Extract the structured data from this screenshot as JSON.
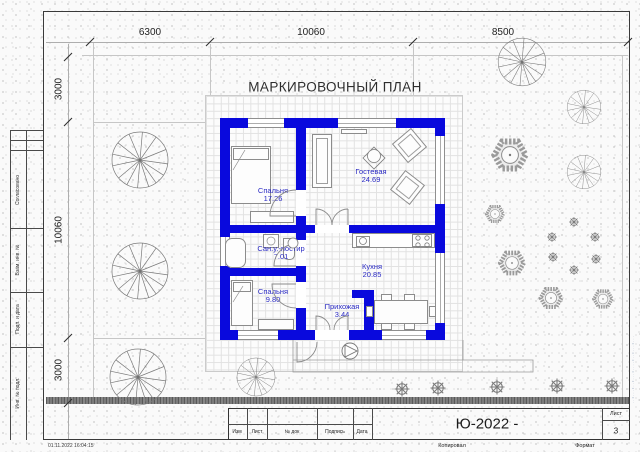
{
  "sheet": {
    "plan_title": "МАРКИРОВОЧНЫЙ ПЛАН",
    "timestamp": "01.11.2022 16:04:15",
    "watermark_text": "···•···•··•····•···•··•···•··"
  },
  "dimensions": {
    "top": [
      "6300",
      "10060",
      "8500"
    ],
    "left": [
      "3000",
      "10060",
      "3000"
    ]
  },
  "rooms": [
    {
      "name": "Спальня",
      "area": "17.26"
    },
    {
      "name": "Гостевая",
      "area": "24.69"
    },
    {
      "name": "Сан.у.-постир",
      "area": "7.01"
    },
    {
      "name": "Спальня",
      "area": "9.80"
    },
    {
      "name": "Кухня",
      "area": "20.85"
    },
    {
      "name": "Прихожая",
      "area": "3.44"
    }
  ],
  "frame": {
    "side_labels": [
      "Согласовано",
      "Взам. инв. №",
      "Подп. и дата",
      "Инв. № подл."
    ],
    "stamp": {
      "columns": [
        "Изм",
        "Лист",
        "№ док",
        "Подпись",
        "Дата"
      ],
      "doc_code": "Ю-2022 -",
      "sheet_label": "Лист",
      "sheet_number": "3",
      "copied_label": "Копировал",
      "format_label": "Формат"
    }
  },
  "colors": {
    "wall_blue": "#0909dd",
    "room_label_blue": "#2b2bc4"
  },
  "symbols": {
    "deciduous_tree": "pinwheel-circle-icon",
    "shrub": "hatched-hexagon-icon",
    "small_bush": "asterisk-circle-icon",
    "entrance_marker": "circle-triangle-icon"
  }
}
